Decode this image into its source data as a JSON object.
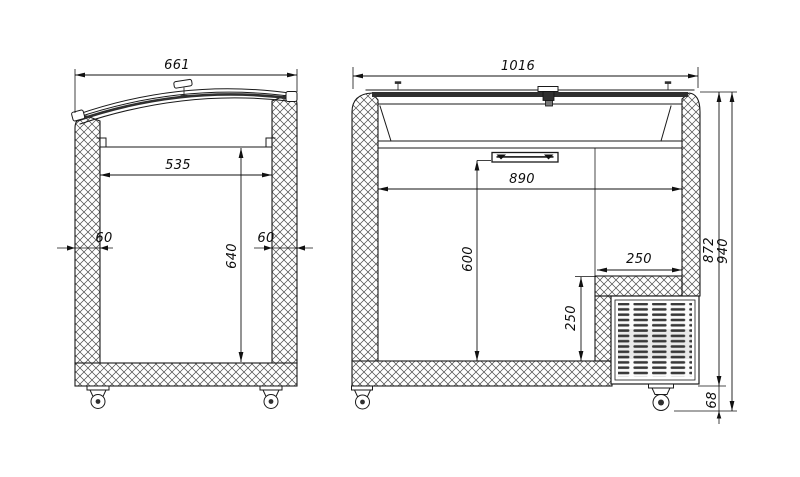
{
  "dims": {
    "left": {
      "overall_width": "661",
      "inner_width": "535",
      "wall_left": "60",
      "wall_right": "60",
      "inner_height": "640"
    },
    "right": {
      "overall_width": "1016",
      "inner_width": "890",
      "inner_height": "600",
      "step_width": "250",
      "step_height": "250",
      "body_height": "872",
      "overall_height": "940",
      "base_height": "68"
    }
  },
  "colors": {
    "line": "#1a1a1a",
    "background": "#ffffff",
    "glass_section": "#2f2f2f"
  }
}
